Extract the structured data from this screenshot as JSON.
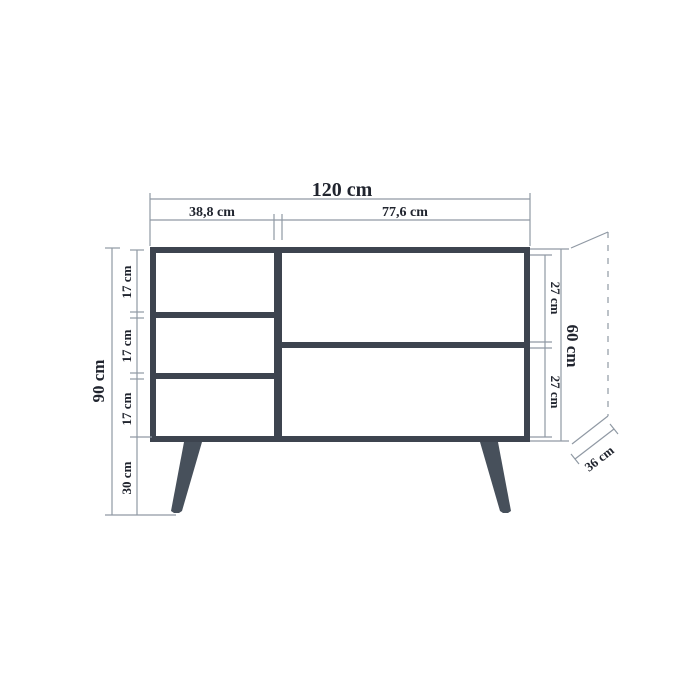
{
  "figure": {
    "kind": "furniture-dimension-diagram",
    "unit": "cm",
    "top_dimensions": {
      "total_width": "120 cm",
      "left_section_width": "38,8 cm",
      "right_section_width": "77,6 cm"
    },
    "left_dimensions": {
      "total_height": "90 cm",
      "segments": [
        "17 cm",
        "17 cm",
        "17 cm",
        "30 cm"
      ]
    },
    "right_dimensions": {
      "total_height": "60 cm",
      "segments": [
        "27 cm",
        "27 cm"
      ]
    },
    "depth_dimension": "36 cm",
    "colors": {
      "background": "#ffffff",
      "cabinet": "#3d444f",
      "leg": "#47505b",
      "dim_line": "#9099a4",
      "text": "#20242e"
    }
  }
}
